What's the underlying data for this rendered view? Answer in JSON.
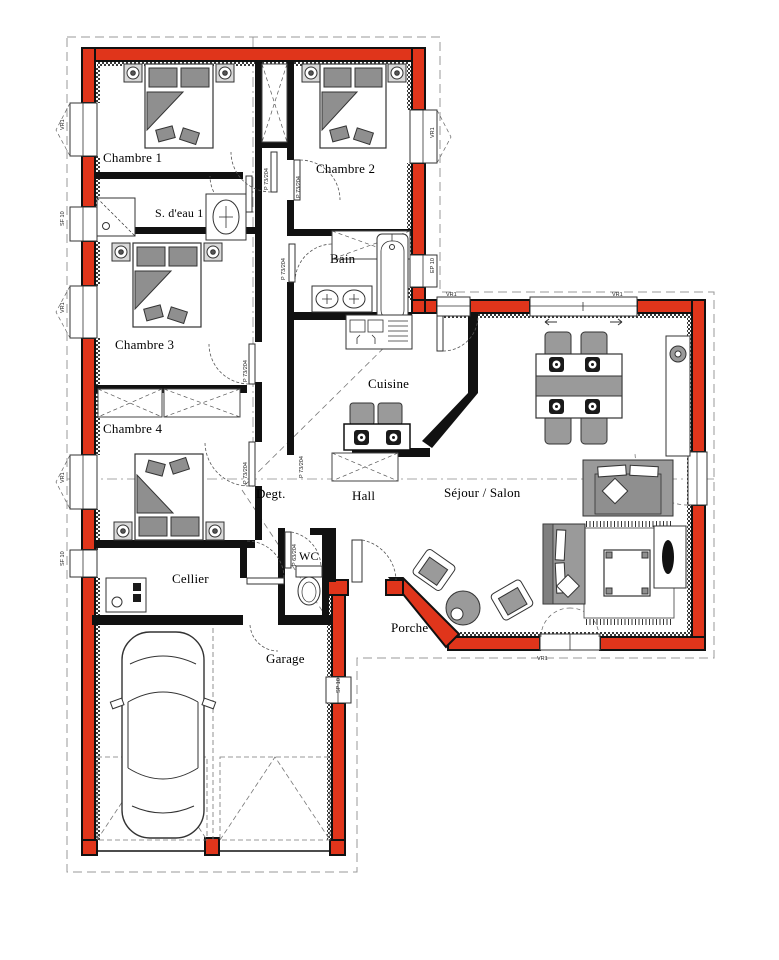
{
  "rooms": {
    "chambre1": "Chambre 1",
    "chambre2": "Chambre 2",
    "sdeau1": "S. d'eau 1",
    "bain": "Bain",
    "chambre3": "Chambre 3",
    "chambre4": "Chambre 4",
    "cuisine": "Cuisine",
    "degt": "Degt.",
    "hall": "Hall",
    "sejour": "Séjour / Salon",
    "cellier": "Cellier",
    "wc": "WC",
    "garage": "Garage",
    "porche": "Porche"
  },
  "labels": {
    "door_std": "P 73/204",
    "door_wc": "P 63/204",
    "window_vr": "VR1",
    "window_sf": "SF 10",
    "window_ep": "EP 10",
    "window_sp": "SP 10"
  },
  "colors": {
    "wall_red": "#e0351b",
    "wall_black": "#111111",
    "furniture_gray": "#9a9a9a"
  }
}
